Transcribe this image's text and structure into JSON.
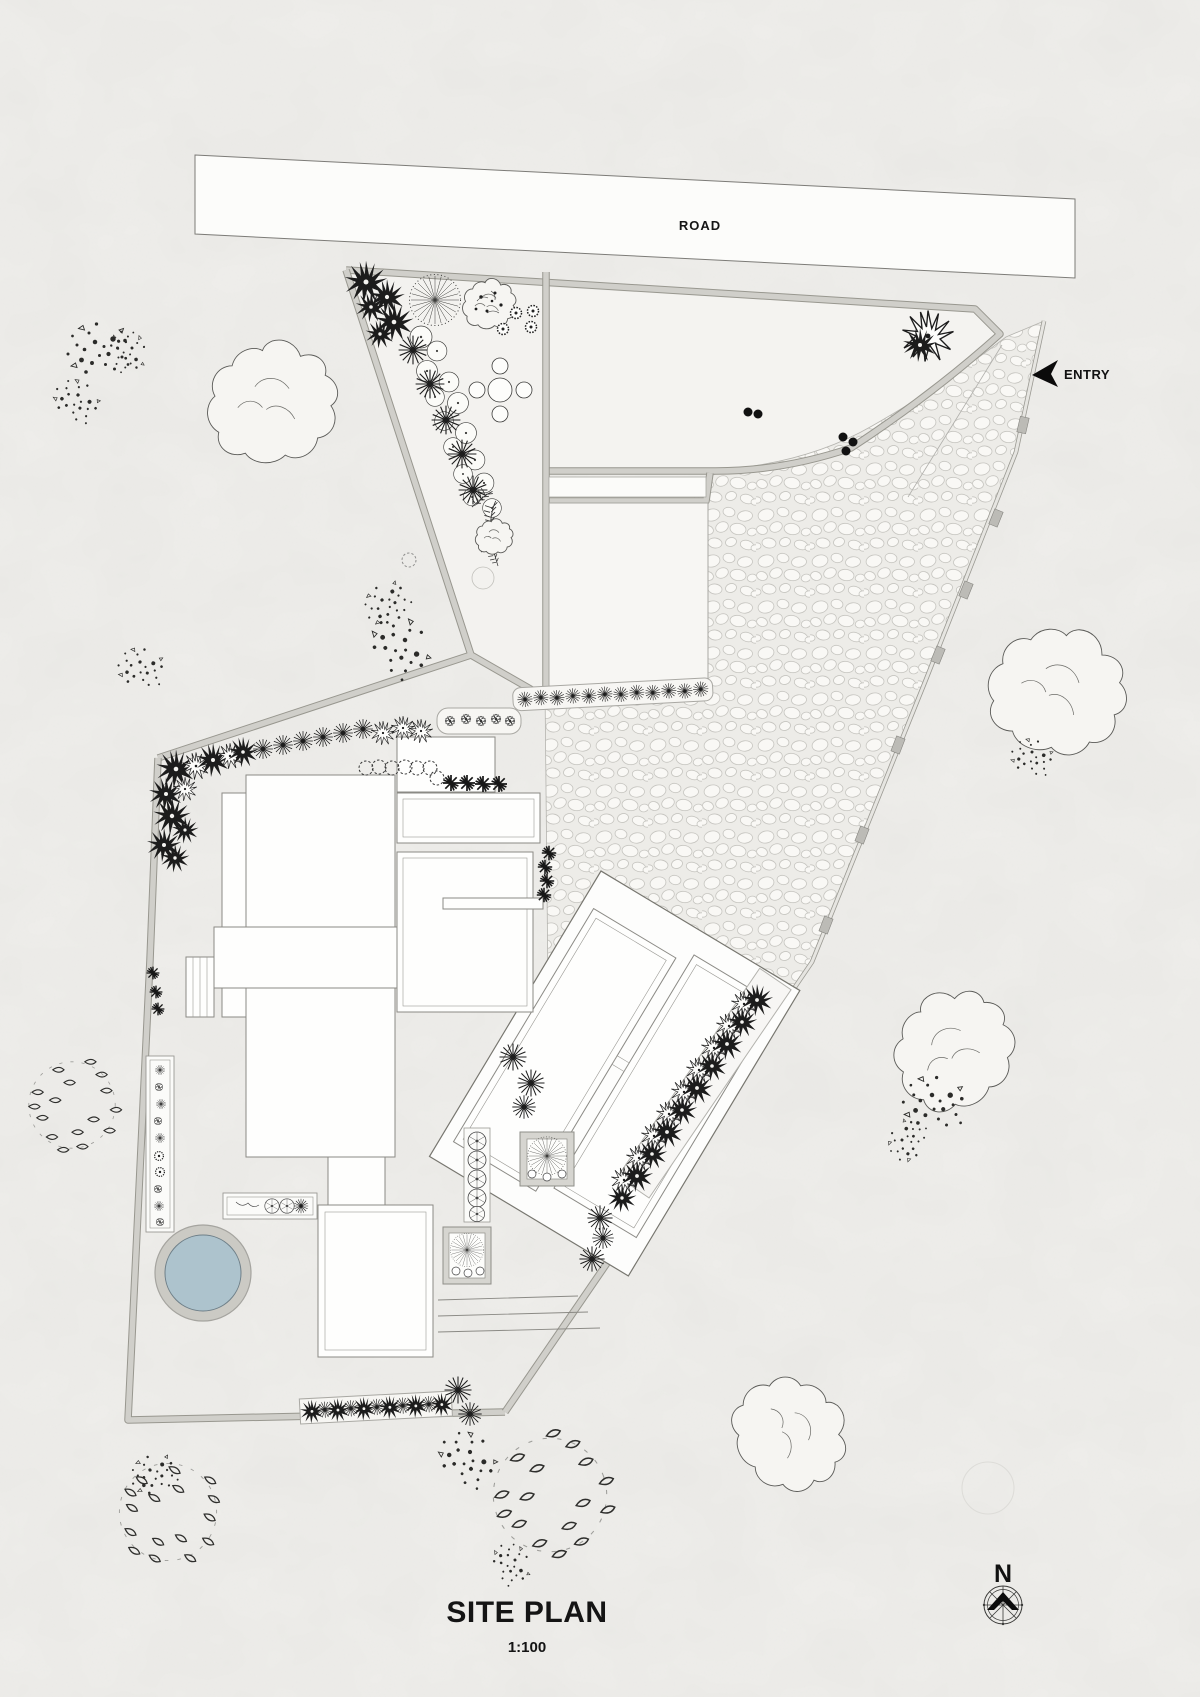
{
  "title": {
    "text": "SITE PLAN",
    "scale": "1:100"
  },
  "labels": {
    "road": "ROAD",
    "entry": "ENTRY",
    "north": "N"
  },
  "colors": {
    "paper": "#f0efec",
    "wall_fill": "#d0cfca",
    "wall_edge": "#98978f",
    "gravel_bg": "#edece8",
    "pebble": "#f9f8f5",
    "pool_water": "#adc3cd",
    "pool_rim": "#c9c8c2",
    "plant_dark": "#1c1c1c",
    "line": "#8b8a85"
  }
}
